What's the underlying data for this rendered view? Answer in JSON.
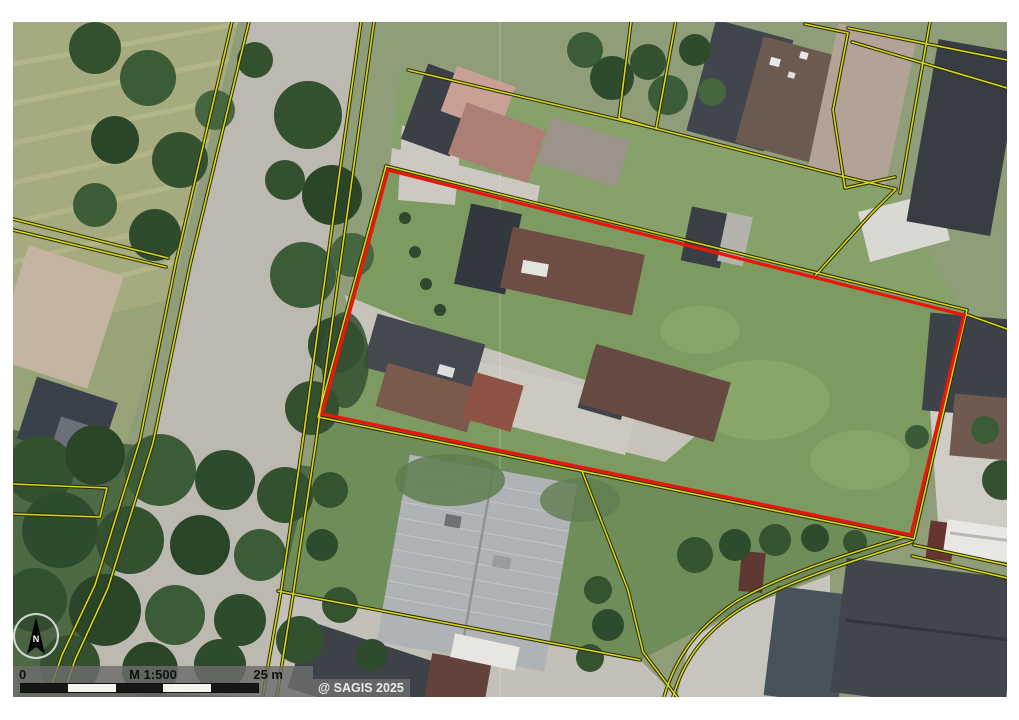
{
  "map": {
    "attribution": "@ SAGIS 2025",
    "scalebar": {
      "zero": "0",
      "scale": "M 1:500",
      "distance": "25 m"
    },
    "compass": {
      "north": "N"
    },
    "colors": {
      "parcel_highlight": "#e8170b",
      "cadastral_line": "#d4d71f",
      "cadastral_casing": "#2a2a00"
    }
  }
}
